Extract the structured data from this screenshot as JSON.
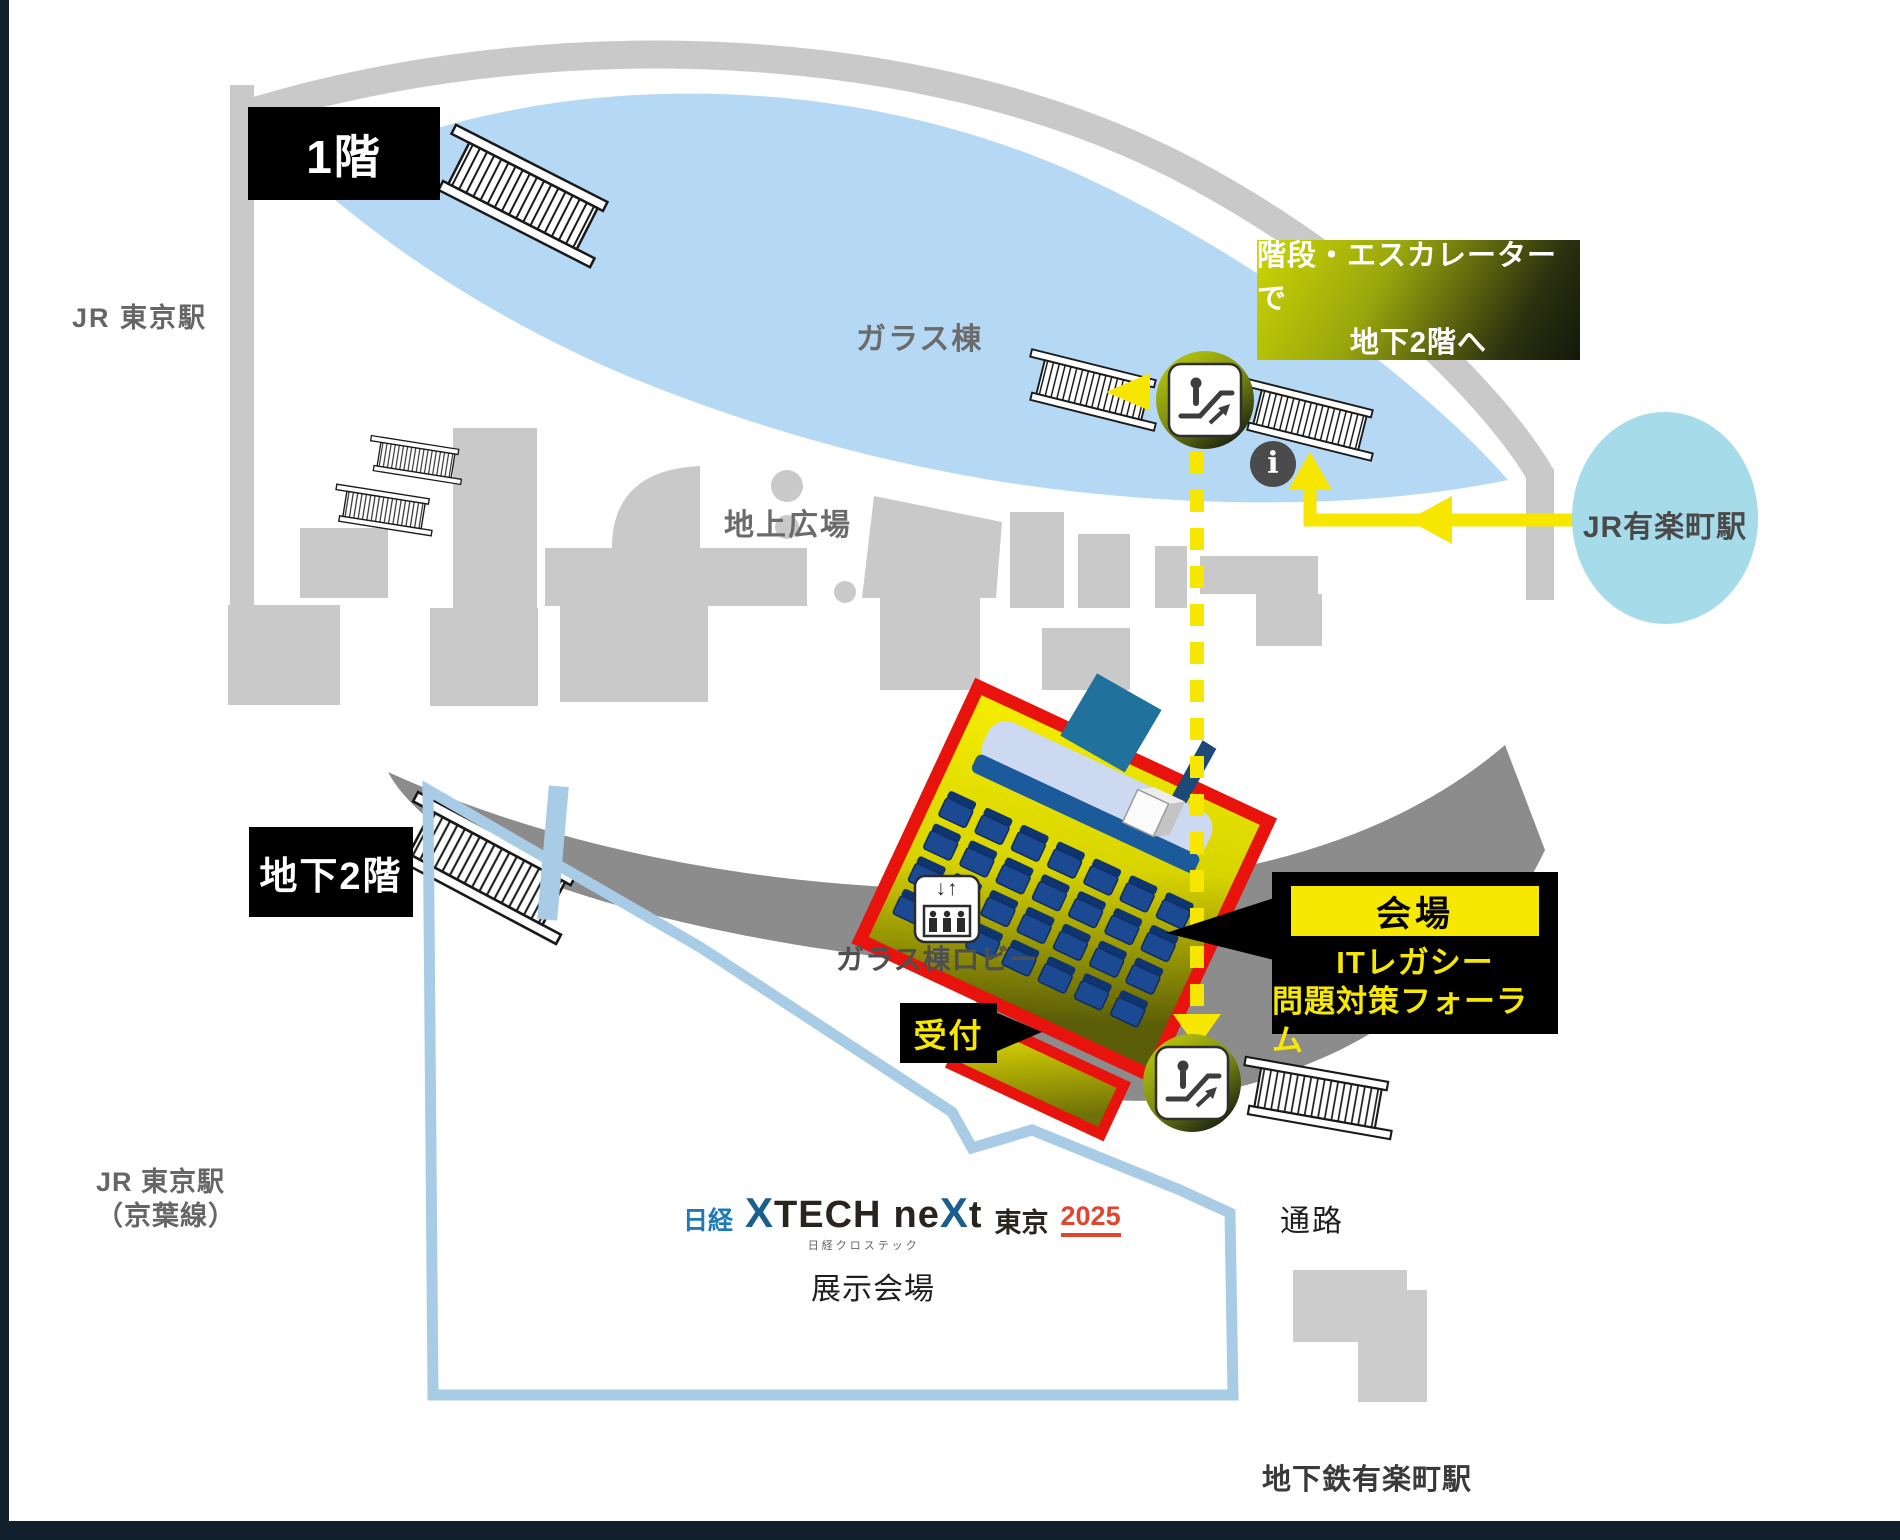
{
  "map": {
    "floor1_label": "1階",
    "floor_b2_label": "地下2階",
    "stations": {
      "jr_tokyo": "JR 東京駅",
      "jr_tokyo_keiyo_line1": "JR 東京駅",
      "jr_tokyo_keiyo_line2": "（京葉線）",
      "jr_yurakucho": "JR有楽町駅",
      "subway_yurakucho": "地下鉄有楽町駅"
    },
    "areas": {
      "glass_tower": "ガラス棟",
      "ground_plaza": "地上広場",
      "seminar_rooms": "セミナー室",
      "glass_lobby": "ガラス棟ロビー",
      "exhibition_hall": "展示会場",
      "passage": "通路"
    },
    "route_note": {
      "line1": "階段・エスカレーターで",
      "line2": "地下2階へ"
    },
    "venue": {
      "label": "会場",
      "event_line1": "ITレガシー",
      "event_line2": "問題対策フォーラム",
      "reception_label": "受付"
    },
    "logo": {
      "nikkei": "日経",
      "xtech_x": "X",
      "xtech_tail": "TECH",
      "next_head": "ne",
      "next_x": "X",
      "next_tail": "t",
      "subtitle": "日経クロステック",
      "city": "東京",
      "year": "2025"
    },
    "icons": {
      "info_glyph": "i",
      "elevator_arrows": "↓↑"
    },
    "colors": {
      "route_yellow": "#f7e600",
      "venue_red": "#e8130c",
      "glass_blue": "#b5d8f4",
      "station_cyan": "#a6dbe9",
      "wall_gray": "#c9c9c9",
      "b2_gray": "#8c8c8c",
      "frame_navy": "#12202e"
    }
  }
}
